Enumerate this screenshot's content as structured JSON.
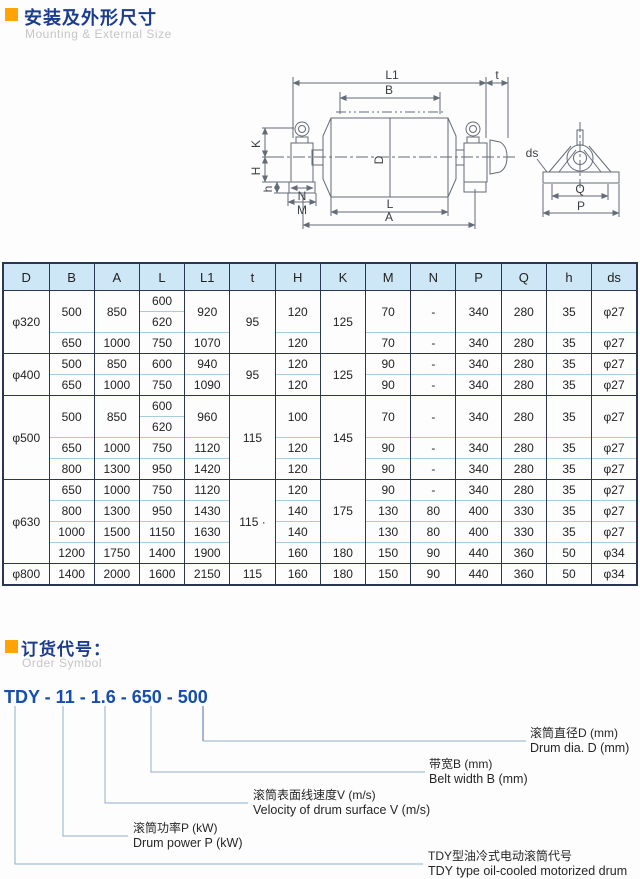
{
  "section1": {
    "title_zh": "安装及外形尺寸",
    "title_en": "Mounting & External Size"
  },
  "drawing": {
    "dims": {
      "L1": "L1",
      "t": "t",
      "B": "B",
      "D": "D",
      "K": "K",
      "H": "H",
      "h": "h",
      "N": "N",
      "M": "M",
      "L": "L",
      "A": "A",
      "ds": "ds",
      "Q": "Q",
      "P": "P"
    }
  },
  "table": {
    "headers": [
      "D",
      "B",
      "A",
      "L",
      "L1",
      "t",
      "H",
      "K",
      "M",
      "N",
      "P",
      "Q",
      "h",
      "ds"
    ],
    "group_rows": [
      3,
      5,
      9,
      13
    ],
    "rows": [
      [
        {
          "v": "φ320",
          "rs": 3
        },
        {
          "v": "500",
          "rs": 2
        },
        {
          "v": "850",
          "rs": 2
        },
        {
          "v": "600"
        },
        {
          "v": "920",
          "rs": 2
        },
        {
          "v": "95",
          "rs": 3
        },
        {
          "v": "120",
          "rs": 2
        },
        {
          "v": "125",
          "rs": 3
        },
        {
          "v": "70",
          "rs": 2
        },
        {
          "v": "-",
          "rs": 2
        },
        {
          "v": "340",
          "rs": 2
        },
        {
          "v": "280",
          "rs": 2
        },
        {
          "v": "35",
          "rs": 2
        },
        {
          "v": "φ27",
          "rs": 2
        }
      ],
      [
        {
          "v": "620"
        }
      ],
      [
        {
          "v": "650"
        },
        {
          "v": "1000"
        },
        {
          "v": "750"
        },
        {
          "v": "1070"
        },
        {
          "v": "120"
        },
        {
          "v": "70"
        },
        {
          "v": "-"
        },
        {
          "v": "340"
        },
        {
          "v": "280"
        },
        {
          "v": "35"
        },
        {
          "v": "φ27"
        }
      ],
      [
        {
          "v": "φ400",
          "rs": 2
        },
        {
          "v": "500"
        },
        {
          "v": "850"
        },
        {
          "v": "600"
        },
        {
          "v": "940"
        },
        {
          "v": "95",
          "rs": 2
        },
        {
          "v": "120"
        },
        {
          "v": "125",
          "rs": 2
        },
        {
          "v": "90"
        },
        {
          "v": "-"
        },
        {
          "v": "340"
        },
        {
          "v": "280"
        },
        {
          "v": "35"
        },
        {
          "v": "φ27"
        }
      ],
      [
        {
          "v": "650"
        },
        {
          "v": "1000"
        },
        {
          "v": "750"
        },
        {
          "v": "1090"
        },
        {
          "v": "120"
        },
        {
          "v": "90"
        },
        {
          "v": "-"
        },
        {
          "v": "340"
        },
        {
          "v": "280"
        },
        {
          "v": "35"
        },
        {
          "v": "φ27"
        }
      ],
      [
        {
          "v": "φ500",
          "rs": 4
        },
        {
          "v": "500",
          "rs": 2
        },
        {
          "v": "850",
          "rs": 2
        },
        {
          "v": "600"
        },
        {
          "v": "960",
          "rs": 2
        },
        {
          "v": "115",
          "rs": 4
        },
        {
          "v": "100",
          "rs": 2
        },
        {
          "v": "145",
          "rs": 4
        },
        {
          "v": "70",
          "rs": 2
        },
        {
          "v": "-",
          "rs": 2
        },
        {
          "v": "340",
          "rs": 2
        },
        {
          "v": "280",
          "rs": 2
        },
        {
          "v": "35",
          "rs": 2
        },
        {
          "v": "φ27",
          "rs": 2
        }
      ],
      [
        {
          "v": "620"
        }
      ],
      [
        {
          "v": "650"
        },
        {
          "v": "1000"
        },
        {
          "v": "750"
        },
        {
          "v": "1120"
        },
        {
          "v": "120"
        },
        {
          "v": "90"
        },
        {
          "v": "-"
        },
        {
          "v": "340"
        },
        {
          "v": "280"
        },
        {
          "v": "35"
        },
        {
          "v": "φ27"
        }
      ],
      [
        {
          "v": "800"
        },
        {
          "v": "1300"
        },
        {
          "v": "950"
        },
        {
          "v": "1420"
        },
        {
          "v": "120"
        },
        {
          "v": "90"
        },
        {
          "v": "-"
        },
        {
          "v": "340"
        },
        {
          "v": "280"
        },
        {
          "v": "35"
        },
        {
          "v": "φ27"
        }
      ],
      [
        {
          "v": "φ630",
          "rs": 4
        },
        {
          "v": "650"
        },
        {
          "v": "1000"
        },
        {
          "v": "750"
        },
        {
          "v": "1120"
        },
        {
          "v": "115 ·",
          "rs": 4
        },
        {
          "v": "120"
        },
        {
          "v": "175",
          "rs": 3
        },
        {
          "v": "90"
        },
        {
          "v": "-"
        },
        {
          "v": "340"
        },
        {
          "v": "280"
        },
        {
          "v": "35"
        },
        {
          "v": "φ27"
        }
      ],
      [
        {
          "v": "800"
        },
        {
          "v": "1300"
        },
        {
          "v": "950"
        },
        {
          "v": "1430"
        },
        {
          "v": "140"
        },
        {
          "v": "130"
        },
        {
          "v": "80"
        },
        {
          "v": "400"
        },
        {
          "v": "330"
        },
        {
          "v": "35"
        },
        {
          "v": "φ27"
        }
      ],
      [
        {
          "v": "1000"
        },
        {
          "v": "1500"
        },
        {
          "v": "1150"
        },
        {
          "v": "1630"
        },
        {
          "v": "140"
        },
        {
          "v": "130"
        },
        {
          "v": "80"
        },
        {
          "v": "400"
        },
        {
          "v": "330"
        },
        {
          "v": "35"
        },
        {
          "v": "φ27"
        }
      ],
      [
        {
          "v": "1200"
        },
        {
          "v": "1750"
        },
        {
          "v": "1400"
        },
        {
          "v": "1900"
        },
        {
          "v": "160"
        },
        {
          "v": "180"
        },
        {
          "v": "150"
        },
        {
          "v": "90"
        },
        {
          "v": "440"
        },
        {
          "v": "360"
        },
        {
          "v": "50"
        },
        {
          "v": "φ34"
        }
      ],
      [
        {
          "v": "φ800"
        },
        {
          "v": "1400"
        },
        {
          "v": "2000"
        },
        {
          "v": "1600"
        },
        {
          "v": "2150"
        },
        {
          "v": "115"
        },
        {
          "v": "160"
        },
        {
          "v": "180"
        },
        {
          "v": "150"
        },
        {
          "v": "90"
        },
        {
          "v": "440"
        },
        {
          "v": "360"
        },
        {
          "v": "50"
        },
        {
          "v": "φ34"
        }
      ]
    ]
  },
  "section2": {
    "title_zh": "订货代号：",
    "title_en": "Order Symbol",
    "code": "TDY - 11 - 1.6 - 650 - 500",
    "callouts": [
      {
        "zh": "滚筒直径D (mm)",
        "en": "Drum dia. D (mm)"
      },
      {
        "zh": "带宽B (mm)",
        "en": "Belt width B (mm)"
      },
      {
        "zh": "滚筒表面线速度V (m/s)",
        "en": "Velocity of drum surface V (m/s)"
      },
      {
        "zh": "滚筒功率P (kW)",
        "en": "Drum power P (kW)"
      },
      {
        "zh": "TDY型油冷式电动滚筒代号",
        "en": "TDY type oil-cooled motorized drum"
      }
    ]
  }
}
